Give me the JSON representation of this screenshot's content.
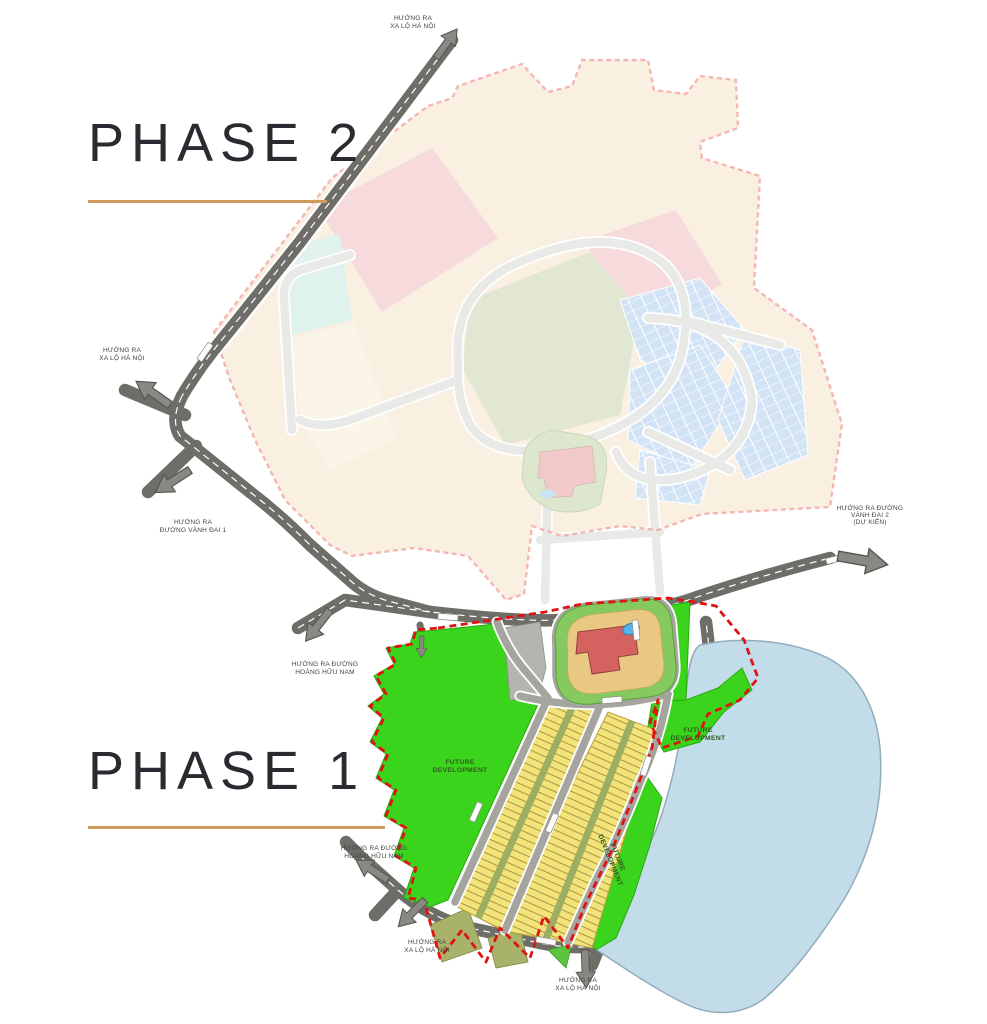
{
  "phases": {
    "phase2": {
      "label": "PHASE 2"
    },
    "phase1": {
      "label": "PHASE 1"
    }
  },
  "areas": {
    "future_line1": "FUTURE",
    "future_line2": "DEVELOPMENT"
  },
  "directions": {
    "top": {
      "line1": "HƯỚNG RA",
      "line2": "XA LỘ HÀ NỘI"
    },
    "left_upper": {
      "line1": "HƯỚNG RA",
      "line2": "XA LỘ HÀ NỘI"
    },
    "left_lower": {
      "line1": "HƯỚNG RA",
      "line2": "ĐƯỜNG VÀNH ĐAI 1"
    },
    "right": {
      "line1": "HƯỚNG RA ĐƯỜNG",
      "line2": "VÀNH ĐAI 2",
      "line3": "(DỰ KIẾN)"
    },
    "mid_left": {
      "line1": "HƯỚNG RA ĐƯỜNG",
      "line2": "HOÀNG HỮU NAM"
    },
    "bottom_left_upper": {
      "line1": "HƯỚNG RA ĐƯỜNG",
      "line2": "HOÀNG HỮU NAM"
    },
    "bottom_left_lower": {
      "line1": "HƯỚNG RA",
      "line2": "XA LỘ HÀ NỘI"
    },
    "bottom_center": {
      "line1": "HƯỚNG RA",
      "line2": "XA LỘ HÀ NỘI"
    }
  },
  "colors": {
    "phase_underline": "#cf9a5c",
    "phase_text": "#2a2a31",
    "phase1_boundary_red": "#e11212",
    "phase2_boundary_red": "#ef8f8f",
    "future_green": "#3bd41d",
    "villas_yellow": "#f2e37a",
    "water_blue": "#c3dcea",
    "main_road_gray": "#6f6d68",
    "phase2_peach": "#f4e0c2",
    "phase2_pink": "#efb3b6",
    "phase2_green": "#c3cfa4",
    "phase2_blue": "#a3c6ee",
    "clubhouse_red": "#d4635f",
    "pool_blue": "#58b4e8"
  }
}
